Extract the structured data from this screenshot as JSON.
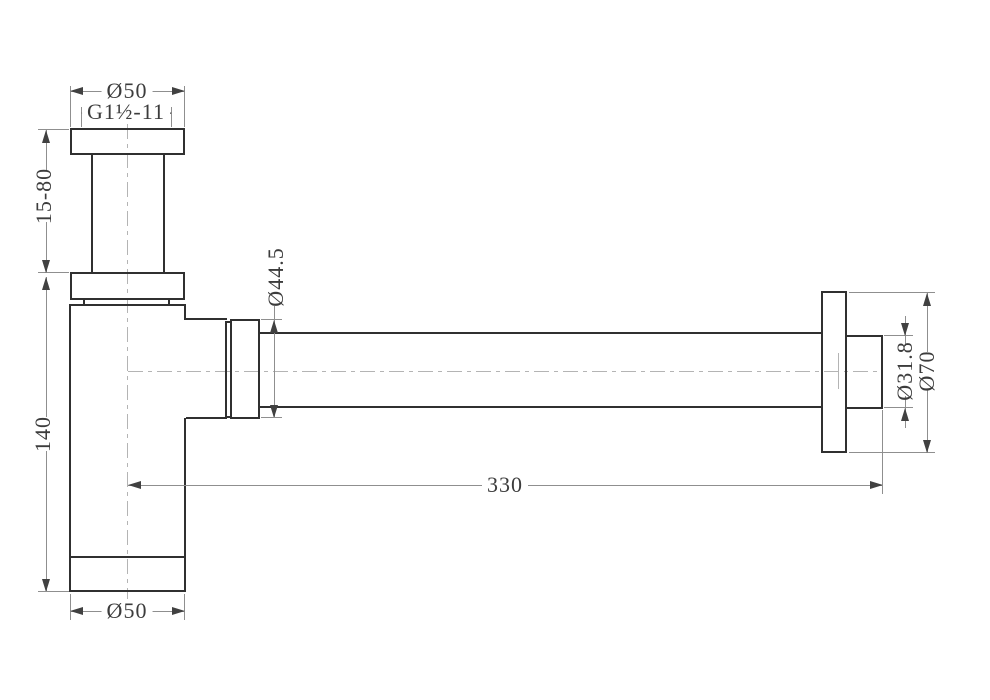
{
  "drawing": {
    "background_color": "#ffffff",
    "outline_color": "#303030",
    "dimension_line_color": "#8f8f8f",
    "centerline_color": "#b4b4b4",
    "text_color": "#3c3c3c",
    "labels": {
      "top_diameter": "Ø50",
      "thread_spec": "G1½-11",
      "inlet_height_range": "15-80",
      "nut_diameter": "Ø44.5",
      "body_height": "140",
      "pipe_length": "330",
      "outlet_diameter": "Ø31.8",
      "flange_diameter": "Ø70",
      "body_diameter": "Ø50"
    }
  }
}
